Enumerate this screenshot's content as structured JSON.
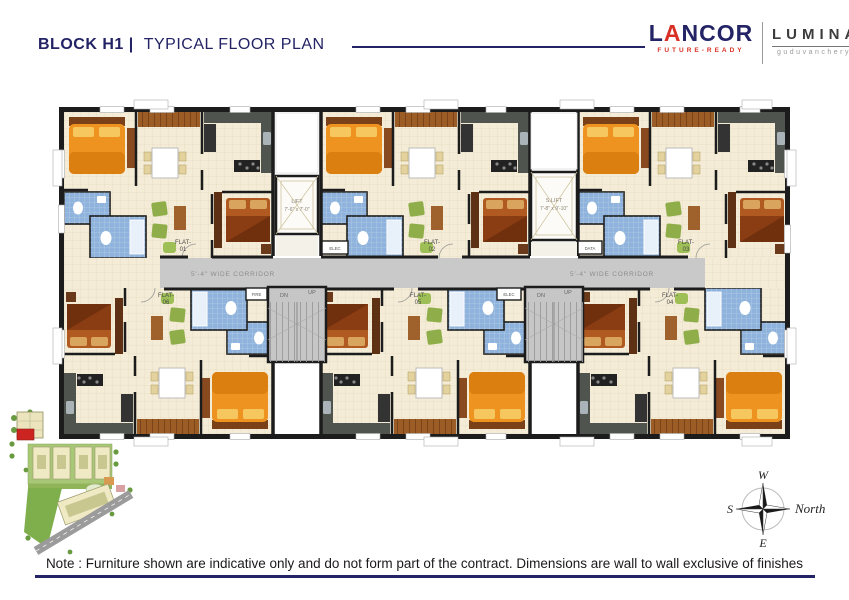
{
  "header": {
    "block": "BLOCK H1 |",
    "title": "TYPICAL FLOOR PLAN"
  },
  "brand": {
    "name_pre": "L",
    "name_a": "A",
    "name_post": "NCOR",
    "tagline": "FUTURE-READY",
    "project": "LUMINA",
    "location": "guduvanchery"
  },
  "plan": {
    "flat_prefix": "FLAT-",
    "flats": [
      "01",
      "02",
      "03",
      "04",
      "05",
      "06"
    ],
    "lift1_name": "LIFT",
    "lift1_size": "7'-6\" x 7'-0\"",
    "lift2_name": "S.LIFT",
    "lift2_size": "7'-8\" x 9'-10\"",
    "corridor": "5'-4\" WIDE CORRIDOR",
    "dn": "DN",
    "up": "UP",
    "elec": "ELEC",
    "data": "DATA",
    "fire": "FIRE"
  },
  "compass": {
    "top": "W",
    "left": "S",
    "bottom": "E",
    "right": "North"
  },
  "note": "Note : Furniture shown are indicative only and do not form part of the contract. Dimensions are wall to wall exclusive of finishes",
  "colors": {
    "navy": "#232366",
    "red": "#d93025",
    "floor": "#f4ecd6",
    "bath_blue": "#8fb3dc",
    "corridor_gray": "#c9c9c9",
    "wall_black": "#1c1c1c",
    "bed_orange": "#ef9320",
    "bed_brown": "#b05a22",
    "sofa_green": "#8fae4a",
    "wood": "#9c5c26"
  }
}
